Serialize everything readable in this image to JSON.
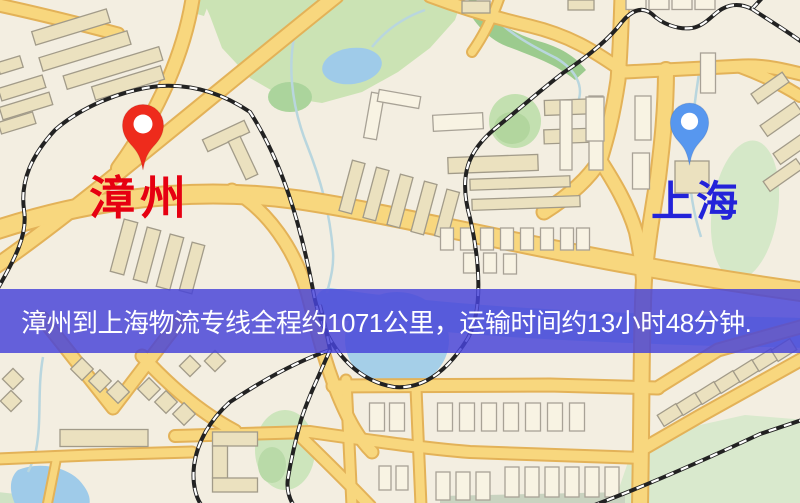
{
  "banner": {
    "text": "漳州到上海物流专线全程约1071公里，运输时间约13小时48分钟.",
    "background_color": "#4743d8",
    "text_color": "#ffffff"
  },
  "markers": [
    {
      "role": "origin",
      "city": "漳州",
      "pin_color": "#ee2b1c",
      "label_color": "#e60011"
    },
    {
      "role": "destination",
      "city": "上海",
      "pin_color": "#5797ef",
      "label_color": "#2323d9"
    }
  ],
  "route": {
    "origin": "漳州",
    "destination": "上海",
    "distance_km": "1071",
    "duration": "13小时48分钟"
  },
  "map_colors": {
    "background": "#f3eee1",
    "road_fill": "#f8d77e",
    "road_casing": "#e3b258",
    "park": "#cbe3b4",
    "water": "#9fcbe9",
    "railway": "#222222"
  }
}
